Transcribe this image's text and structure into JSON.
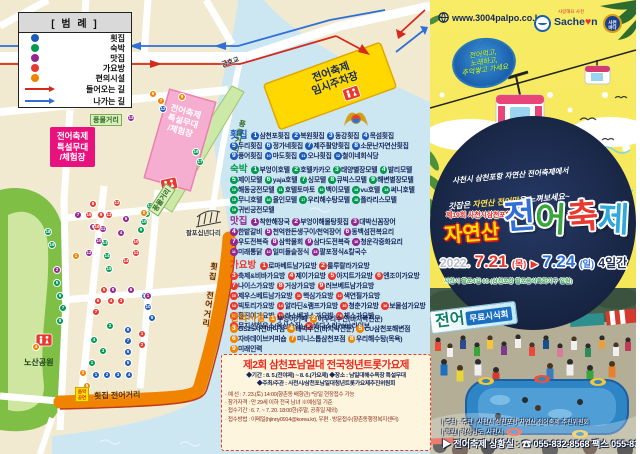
{
  "legend": {
    "title": "[ 범 례 ]",
    "items": [
      {
        "label": "횟집",
        "color": "blue"
      },
      {
        "label": "숙박",
        "color": "green"
      },
      {
        "label": "맛집",
        "color": "purple"
      },
      {
        "label": "가요방",
        "color": "red"
      },
      {
        "label": "편의시설",
        "color": "orange"
      }
    ],
    "arrows": [
      {
        "label": "들어오는 길",
        "color": "red"
      },
      {
        "label": "나가는 길",
        "color": "blue"
      }
    ]
  },
  "map": {
    "labels": {
      "bridge_top": "금호교",
      "bridge_small": "팔포십년다리",
      "park": "노산공원",
      "street_market_tag1": "풍물거리",
      "street_market_tag2": "풍물거리",
      "street_market_vertical": "풍물거리",
      "fish_street_v": "횟집 전어거리",
      "fish_street_h": "횟집 전어거리",
      "parking": [
        "전어축제",
        "임시주차장"
      ],
      "stage_callout": [
        "전어축제",
        "특설무대",
        "/체험장"
      ],
      "stage_area": [
        "전어축제",
        "특설무대",
        "/체험장"
      ],
      "music_sign": [
        "음악",
        "공연"
      ]
    },
    "categories": [
      {
        "name": "횟집",
        "color": "blue",
        "items": [
          "삼천포횟집",
          "복원횟집",
          "동강횟집",
          "목섬횟집",
          "두리횟집",
          "정가네횟집",
          "제주활양횟집",
          "소문난자연산횟집",
          "풍어횟집",
          "마도횟집",
          "오나횟집",
          "철이네회식당"
        ]
      },
      {
        "name": "숙박",
        "color": "green",
        "items": [
          "부엉이호텔",
          "호텔카카오",
          "태양별장모텔",
          "발리모텔",
          "제이모텔",
          "yaja호텔",
          "싱모텔",
          "큐빅스모텔",
          "해변별장모텔",
          "해동궁전모텔",
          "호텔토마토",
          "백이모텔",
          "vu호텔",
          "써니호텔",
          "무니호텔",
          "올인모텔",
          "우리해수탕모텔",
          "폴라리스모텔",
          "귀빈궁전모텔"
        ]
      },
      {
        "name": "맛집",
        "color": "purple",
        "items": [
          "착한해장국",
          "부엉이해물탕횟집",
          "대박신꼼장어",
          "한밭갈비",
          "천억한돈생구이/천억장어",
          "동백섬전복요리",
          "우도전복죽",
          "삼학물회",
          "삼다도전복죽",
          "청운각중화요리",
          "미래통닭",
          "일미돌솥정식",
          "팔포정식&칼국수"
        ]
      },
      {
        "name": "가요방",
        "color": "red",
        "items": [
          "로마베트남가요방",
          "룰루랄라가요방",
          "축제&비바가요방",
          "제이가요방",
          "아지트가요방",
          "엔조이가요방",
          "나이스가요방",
          "거상가요방",
          "러브베트남가요방",
          "제우스베트남가요방",
          "핵심가요방",
          "색연필가요방",
          "빅토리가요방",
          "알라딘&램프가요방",
          "청춘가요방",
          "보물섬가요방",
          "황진이가요방",
          "라스베가스가요방",
          "체스가요방",
          "뮤지션하우스(옥상술집)",
          "바다소리7080라이브"
        ]
      },
      {
        "name": "편의시설",
        "color": "orange",
        "items": [
          "부엉이카페",
          "어우리수산(바지락전문)",
          "GS25사천바다점",
          "대박수산(바지락전문)",
          "CU삼천포해변점",
          "자바데이브커피숍",
          "미니스톱삼천포점",
          "우리해수탕(목욕)",
          "미래인력"
        ]
      }
    ],
    "colors": {
      "blue": "#1c5bb8",
      "green": "#009a50",
      "purple": "#93278f",
      "red": "#e8392f",
      "orange": "#f08300"
    },
    "markers": [
      {
        "c": "blue",
        "n": 1,
        "x": 96,
        "y": 375
      },
      {
        "c": "blue",
        "n": 2,
        "x": 107,
        "y": 375
      },
      {
        "c": "blue",
        "n": 3,
        "x": 118,
        "y": 375
      },
      {
        "c": "blue",
        "n": 4,
        "x": 129,
        "y": 375
      },
      {
        "c": "blue",
        "n": 5,
        "x": 128,
        "y": 363
      },
      {
        "c": "blue",
        "n": 6,
        "x": 128,
        "y": 352
      },
      {
        "c": "blue",
        "n": 7,
        "x": 128,
        "y": 341
      },
      {
        "c": "blue",
        "n": 8,
        "x": 128,
        "y": 330
      },
      {
        "c": "blue",
        "n": 9,
        "x": 152,
        "y": 318
      },
      {
        "c": "blue",
        "n": 10,
        "x": 148,
        "y": 307
      },
      {
        "c": "blue",
        "n": 11,
        "x": 145,
        "y": 296
      },
      {
        "c": "blue",
        "n": 12,
        "x": 163,
        "y": 109
      },
      {
        "c": "green",
        "n": 1,
        "x": 92,
        "y": 363
      },
      {
        "c": "green",
        "n": 2,
        "x": 110,
        "y": 326
      },
      {
        "c": "green",
        "n": 3,
        "x": 103,
        "y": 351
      },
      {
        "c": "green",
        "n": 4,
        "x": 94,
        "y": 340
      },
      {
        "c": "green",
        "n": 5,
        "x": 57,
        "y": 283
      },
      {
        "c": "green",
        "n": 6,
        "x": 60,
        "y": 296
      },
      {
        "c": "green",
        "n": 7,
        "x": 63,
        "y": 308
      },
      {
        "c": "green",
        "n": 8,
        "x": 60,
        "y": 321
      },
      {
        "c": "green",
        "n": 9,
        "x": 141,
        "y": 230
      },
      {
        "c": "green",
        "n": 10,
        "x": 144,
        "y": 222
      },
      {
        "c": "green",
        "n": 11,
        "x": 147,
        "y": 214
      },
      {
        "c": "green",
        "n": 12,
        "x": 150,
        "y": 206
      },
      {
        "c": "green",
        "n": 13,
        "x": 105,
        "y": 243
      },
      {
        "c": "green",
        "n": 14,
        "x": 107,
        "y": 256
      },
      {
        "c": "green",
        "n": 15,
        "x": 109,
        "y": 269
      },
      {
        "c": "green",
        "n": 16,
        "x": 196,
        "y": 152
      },
      {
        "c": "green",
        "n": 17,
        "x": 200,
        "y": 162
      },
      {
        "c": "green",
        "n": 18,
        "x": 48,
        "y": 232
      },
      {
        "c": "green",
        "n": 19,
        "x": 52,
        "y": 245
      },
      {
        "c": "purple",
        "n": 1,
        "x": 148,
        "y": 296
      },
      {
        "c": "purple",
        "n": 2,
        "x": 57,
        "y": 270
      },
      {
        "c": "purple",
        "n": 3,
        "x": 86,
        "y": 387
      },
      {
        "c": "purple",
        "n": 4,
        "x": 121,
        "y": 233
      },
      {
        "c": "purple",
        "n": 5,
        "x": 126,
        "y": 219
      },
      {
        "c": "purple",
        "n": 6,
        "x": 131,
        "y": 290
      },
      {
        "c": "purple",
        "n": 7,
        "x": 78,
        "y": 215
      },
      {
        "c": "purple",
        "n": 8,
        "x": 93,
        "y": 227
      },
      {
        "c": "purple",
        "n": 9,
        "x": 113,
        "y": 290
      },
      {
        "c": "purple",
        "n": 10,
        "x": 99,
        "y": 241
      },
      {
        "c": "purple",
        "n": 11,
        "x": 103,
        "y": 229
      },
      {
        "c": "purple",
        "n": 12,
        "x": 89,
        "y": 253
      },
      {
        "c": "purple",
        "n": 13,
        "x": 131,
        "y": 118
      },
      {
        "c": "red",
        "n": 1,
        "x": 142,
        "y": 334
      },
      {
        "c": "red",
        "n": 2,
        "x": 142,
        "y": 345
      },
      {
        "c": "red",
        "n": 3,
        "x": 121,
        "y": 301
      },
      {
        "c": "red",
        "n": 4,
        "x": 111,
        "y": 301
      },
      {
        "c": "red",
        "n": 5,
        "x": 104,
        "y": 290
      },
      {
        "c": "red",
        "n": 6,
        "x": 98,
        "y": 301
      },
      {
        "c": "red",
        "n": 7,
        "x": 96,
        "y": 312
      },
      {
        "c": "red",
        "n": 8,
        "x": 93,
        "y": 204
      },
      {
        "c": "red",
        "n": 9,
        "x": 101,
        "y": 215
      },
      {
        "c": "red",
        "n": 10,
        "x": 136,
        "y": 242
      },
      {
        "c": "red",
        "n": 11,
        "x": 136,
        "y": 253
      },
      {
        "c": "red",
        "n": 12,
        "x": 117,
        "y": 203
      },
      {
        "c": "red",
        "n": 13,
        "x": 109,
        "y": 215
      },
      {
        "c": "red",
        "n": 14,
        "x": 126,
        "y": 261
      },
      {
        "c": "red",
        "n": 15,
        "x": 89,
        "y": 215
      },
      {
        "c": "red",
        "n": 16,
        "x": 97,
        "y": 227
      },
      {
        "c": "orange",
        "n": 1,
        "x": 76,
        "y": 256
      },
      {
        "c": "orange",
        "n": 2,
        "x": 83,
        "y": 373
      },
      {
        "c": "orange",
        "n": 3,
        "x": 52,
        "y": 75
      },
      {
        "c": "orange",
        "n": 4,
        "x": 36,
        "y": 347
      },
      {
        "c": "orange",
        "n": 5,
        "x": 87,
        "y": 386
      },
      {
        "c": "orange",
        "n": 6,
        "x": 153,
        "y": 94
      },
      {
        "c": "orange",
        "n": 7,
        "x": 161,
        "y": 101
      },
      {
        "c": "orange",
        "n": 8,
        "x": 144,
        "y": 213
      },
      {
        "c": "orange",
        "n": 9,
        "x": 182,
        "y": 97
      }
    ]
  },
  "notice": {
    "title": "제2회 삼천포남일대 전국청년트롯가요제",
    "line1": "◆기간 : 8. 5.(전야제) ~ 8. 6.(가요제) ◆장소 : 남일대해수욕장 특설무대",
    "line2": "◆주최/주관 : 사천시/삼천포남일대청년트롯가요제추진위원회",
    "details": [
      "· 예      선 : 7. 23.(토) 14:00(향촌동 배향관) *당일 현장접수 가능",
      "· 참가자격 : 만 29세 이하 전국 남녀  ※예심일 기준",
      "· 접수기간 : 6. 7. ~ 7. 20. 18:00한(주말, 공휴일 제외)",
      "· 접수방법 : 이메일(hjinny0914@korea.kr), 우편 · 방문접수(향촌동행정복지센터)"
    ]
  },
  "poster": {
    "website": "www.3004palpo.co.kr",
    "logos": {
      "sacheon_pre": "Sache",
      "sacheon_heart": "♥",
      "sacheon_post": "n",
      "script": "사랑해요 사천",
      "round_badge_lines": [
        "사천",
        "바다"
      ]
    },
    "badge_lines": [
      "전어먹고,",
      "노래하고,",
      "추억쌓고 가세요"
    ],
    "slogan1": "사천시 삼천포항 자연산 전어축제에서",
    "slogan2_pre": "갓잡은 ",
    "slogan2_hl": "자연산 전어맛",
    "slogan2_post": "을 느껴보세요~",
    "edition": "제19회 사천시삼천포항",
    "title_natural": "자연산",
    "title_chars": [
      "전",
      "어",
      "축",
      "제"
    ],
    "title_colors": [
      "#2f6fd6",
      "#3aa53a",
      "#e8392f",
      "#2fa8dc"
    ],
    "date": {
      "year": "2022.",
      "from": "7.21",
      "from_day": "(목)",
      "arrow": "▶",
      "to": "7.24",
      "to_day": "(일)",
      "days": "4일간"
    },
    "address": "사천시 팔포4길 65 (삼천포항 팔포음식특화지구 일원)",
    "banner": {
      "big": "전어",
      "small": "무료시식회"
    },
    "footer": {
      "host": "| 주최 · 주관 | 사천시 삼천포항 자연산 전어축제 추진위원회",
      "support": "| 후원 | 경상남도, 사천시",
      "contact": "▶ 전어축제 상황실 : ☎ 055-832-8568 팩스 055-835-4968 ◀"
    }
  }
}
